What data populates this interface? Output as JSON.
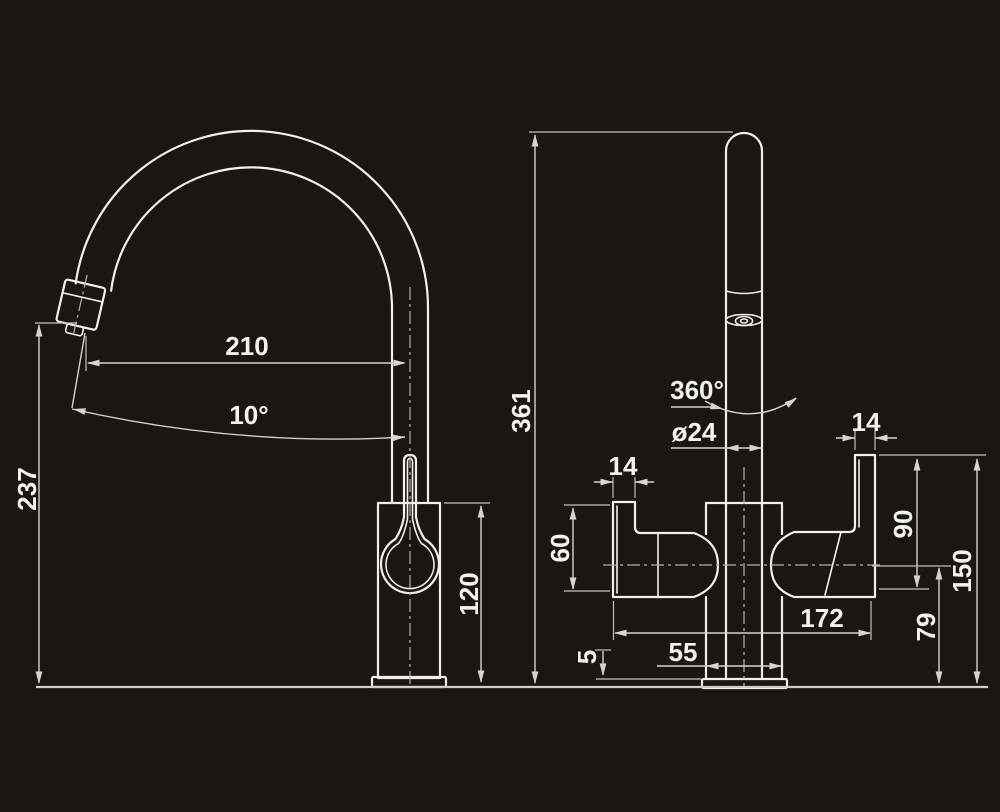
{
  "figure": {
    "type": "technical-dimension-drawing",
    "subject": "kitchen mixer tap, side view and front view",
    "views": [
      "side-view",
      "front-view"
    ]
  },
  "colors": {
    "background": "#1c1613",
    "outline": "#f3f0ea",
    "dimension_lines": "#d6d2cb",
    "centerlines": "#b5b1aa",
    "text": "#f5f3ee"
  },
  "labels": {
    "spout_reach": "210",
    "spout_angle": "10°",
    "spout_outlet_height": "237",
    "body_height": "120",
    "total_height": "361",
    "swivel_rotation": "360°",
    "pipe_diameter": "ø24",
    "left_handle_width": "14",
    "right_handle_width": "14",
    "left_handle_height": "60",
    "right_handle_height": "90",
    "right_handle_total_height": "150",
    "handle_axis_height": "79",
    "handle_span": "172",
    "body_width": "55",
    "base_plate_thickness": "5"
  }
}
